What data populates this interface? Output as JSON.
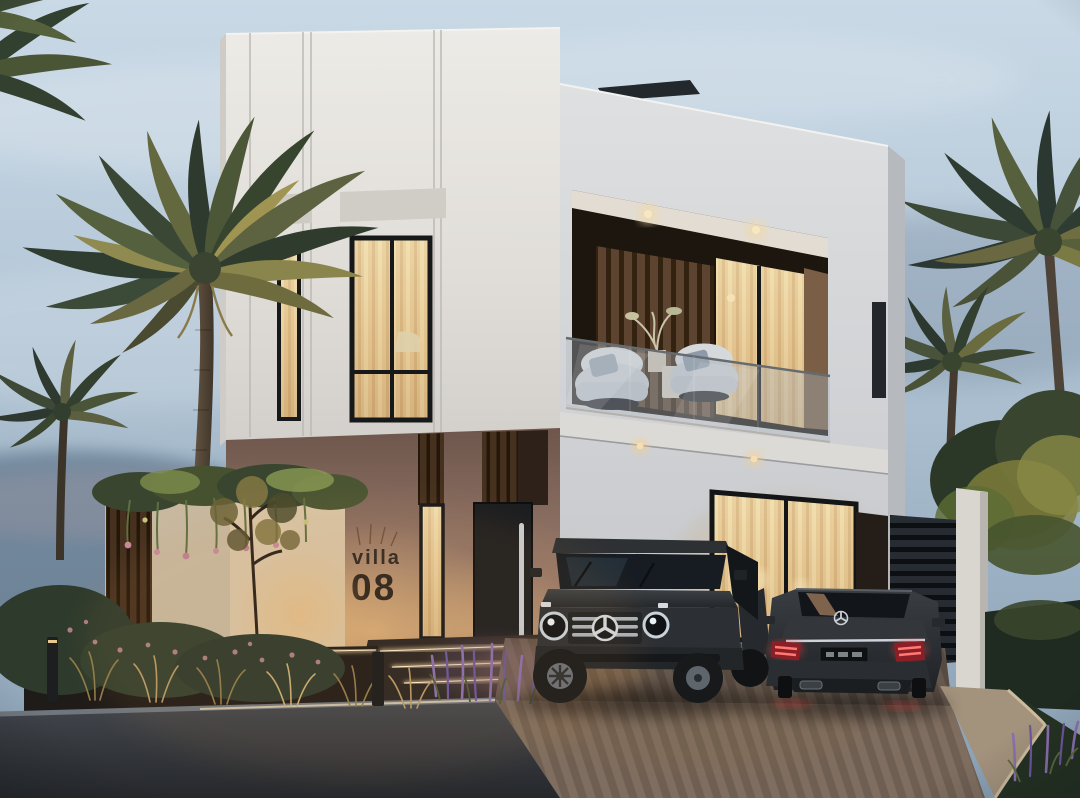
{
  "scene": {
    "title": "Modern villa exterior render at dusk",
    "setting": "dusk",
    "sign": {
      "line1": "villa",
      "line2": "08"
    }
  },
  "icons": {
    "suv_emblem": "mercedes-star-icon",
    "sedan_emblem": "mercedes-star-icon"
  },
  "palette": {
    "sky_top": "#c9d9e6",
    "sky_horizon": "#8aa0b4",
    "facade_white": "#e6e4df",
    "facade_accent_brown": "#97796a",
    "wood_slat_dark": "#46311f",
    "window_glow_warm": "#e9cf9c",
    "taillight_red": "#e0403f",
    "asphalt_dark": "#2d3035",
    "paving_warm": "#6e5d4f",
    "foliage_dark": "#2e3b2e",
    "foliage_lit": "#8a8a46",
    "lavender": "#8a6fae",
    "sign_text": "#2e2722"
  }
}
